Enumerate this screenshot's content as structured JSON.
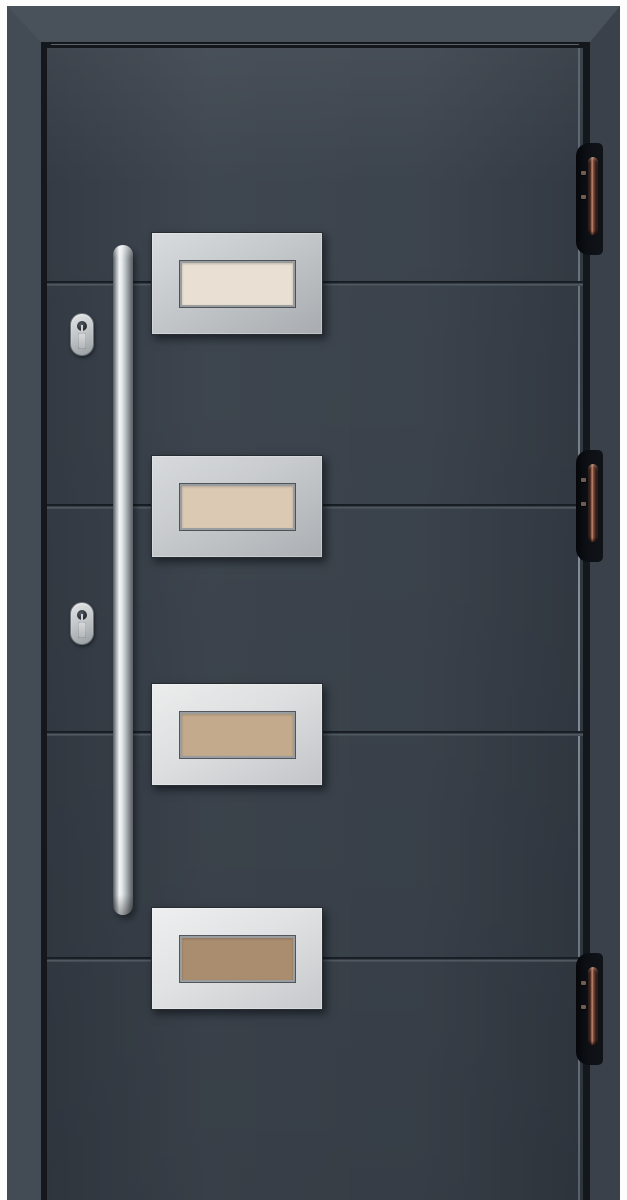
{
  "scene": {
    "subject": "modern anthracite front entry door, front product photo",
    "background_color": "#fdfdfd"
  },
  "palette": {
    "frame_top": "#49515b",
    "frame_left": "#434b55",
    "frame_right": "#3a414b",
    "rebate_shadow": "#14181d",
    "leaf_anthracite": "#38404a",
    "groove_dark": "#1d232a",
    "groove_light": "#545c65",
    "steel_panel_light": "#eceded",
    "steel_panel_mid": "#c4c8cb",
    "handle_steel_highlight": "#f3f6f7",
    "lock_silver": "#c3c7c9",
    "hinge_black": "#0c0f14",
    "hinge_pin_copper": "#b98a74"
  },
  "door": {
    "leaf_color": "#38404a",
    "leaf_finish": "anthracite",
    "groove_count": 4,
    "panels": [
      {
        "label": "glazing-panel-1",
        "glass_color": "#e9dfd2"
      },
      {
        "label": "glazing-panel-2",
        "glass_color": "#dcc9b4"
      },
      {
        "label": "glazing-panel-3",
        "glass_color": "#c4aa8d"
      },
      {
        "label": "glazing-panel-4",
        "glass_color": "#aa8c6f"
      }
    ],
    "handle": {
      "type": "vertical-bar-pull",
      "finish": "stainless-steel"
    },
    "locks": [
      {
        "label": "cylinder-lock-upper"
      },
      {
        "label": "cylinder-lock-lower"
      }
    ],
    "hinges": [
      {
        "label": "hinge-top",
        "pin_finish": "copper-bronze"
      },
      {
        "label": "hinge-middle",
        "pin_finish": "copper-bronze"
      },
      {
        "label": "hinge-bottom",
        "pin_finish": "copper-bronze"
      }
    ]
  }
}
